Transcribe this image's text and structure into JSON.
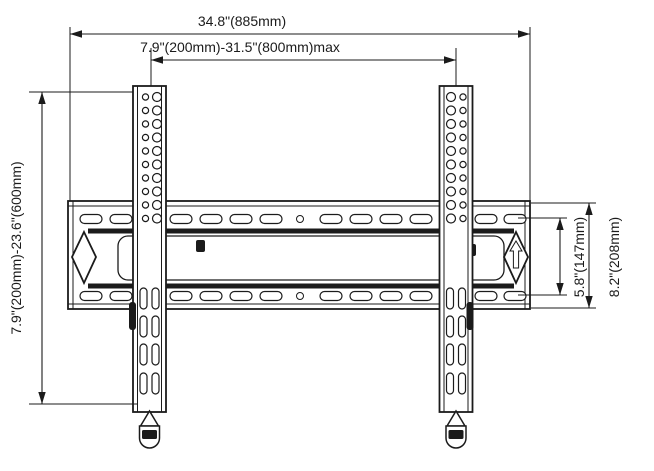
{
  "page": {
    "background": "#ffffff",
    "ink": "#1b1b1b"
  },
  "diagram": {
    "kind": "technical-drawing",
    "subject": "TV wall mount bracket front view with dimension annotations"
  },
  "dimensions": {
    "overall_width": "34.8\"(885mm)",
    "mount_width_range": "7.9\"(200mm)-31.5\"(800mm)max",
    "mount_height_range": "7.9\"(200mm)-23.6\"(600mm)",
    "inner_height": "5.8\"(147mm)",
    "outer_height": "8.2\"(208mm)"
  }
}
